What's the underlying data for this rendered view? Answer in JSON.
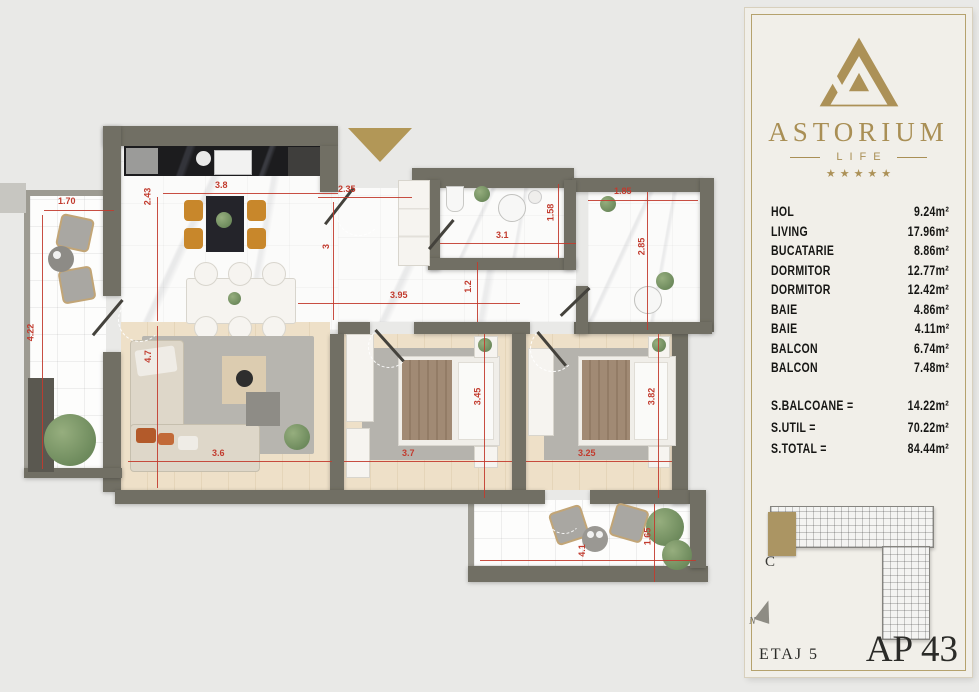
{
  "panel": {
    "brand": {
      "name": "ASTORIUM",
      "sub": "LIFE",
      "stars": "★★★★★"
    },
    "areas": {
      "rows": [
        {
          "label": "HOL",
          "value": "9.24m²"
        },
        {
          "label": "LIVING",
          "value": "17.96m²"
        },
        {
          "label": "BUCATARIE",
          "value": "8.86m²"
        },
        {
          "label": "DORMITOR",
          "value": "12.77m²"
        },
        {
          "label": "DORMITOR",
          "value": "12.42m²"
        },
        {
          "label": "BAIE",
          "value": "4.86m²"
        },
        {
          "label": "BAIE",
          "value": "4.11m²"
        },
        {
          "label": "BALCON",
          "value": "6.74m²"
        },
        {
          "label": "BALCON",
          "value": "7.48m²"
        }
      ],
      "totals": [
        {
          "label": "S.BALCOANE =",
          "value": "14.22m²"
        },
        {
          "label": "S.UTIL =",
          "value": "70.22m²"
        },
        {
          "label": "S.TOTAL =",
          "value": "84.44m²"
        }
      ]
    },
    "keyplan": {
      "section_label": "C",
      "north_label": "N"
    },
    "floor_label": "ETAJ 5",
    "apartment_label": "AP 43"
  },
  "plan": {
    "dimensions": [
      {
        "text": "1.70"
      },
      {
        "text": "3.8"
      },
      {
        "text": "2.35"
      },
      {
        "text": "3.95"
      },
      {
        "text": "3.1"
      },
      {
        "text": "1.85"
      },
      {
        "text": "3.6"
      },
      {
        "text": "3.7"
      },
      {
        "text": "3.25"
      },
      {
        "text": "4.1"
      },
      {
        "text": "4.22"
      },
      {
        "text": "2.43"
      },
      {
        "text": "3"
      },
      {
        "text": "1.2"
      },
      {
        "text": "1.58"
      },
      {
        "text": "2.85"
      },
      {
        "text": "4.7"
      },
      {
        "text": "3.45"
      },
      {
        "text": "3.82"
      },
      {
        "text": "1.65"
      }
    ],
    "colors": {
      "accent_gold": "#ab9157",
      "dimension_red": "#c23b2e",
      "wall": "#716f64"
    }
  }
}
